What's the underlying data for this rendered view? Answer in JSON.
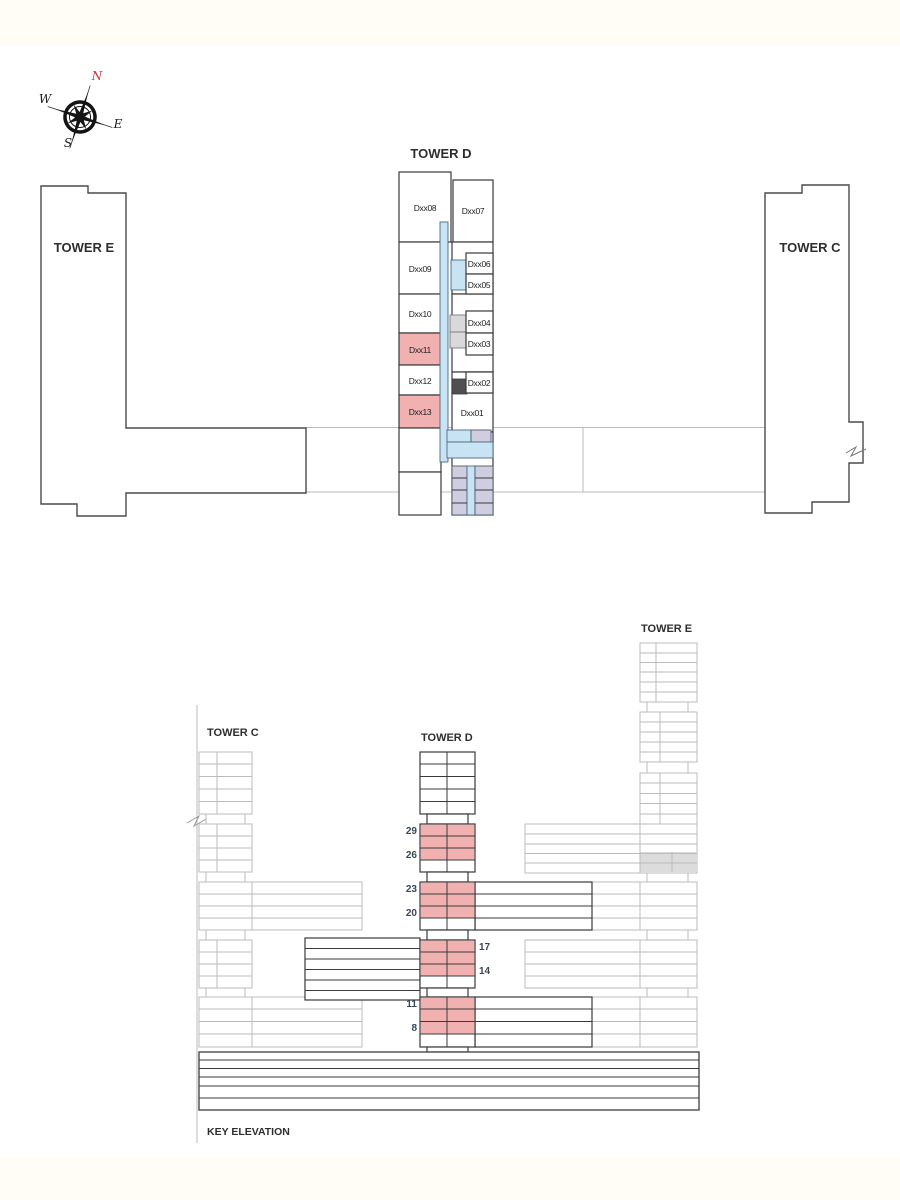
{
  "colors": {
    "highlight_pink": "#f1b1b1",
    "corridor_blue": "#c8e3f3",
    "core_lavender": "#d0cde0",
    "muted_gray": "#dcdcdc",
    "dark_gray_block": "#4f4f4f",
    "outline_dark": "#3a3a3a",
    "outline_faint": "#bbbbbb",
    "north_red": "#cc3333",
    "floor_label_navy": "#3b4557"
  },
  "compass": {
    "north": "N",
    "south": "S",
    "east": "E",
    "west": "W"
  },
  "plan": {
    "tower_d_title": "TOWER D",
    "tower_e_label": "TOWER E",
    "tower_c_label": "TOWER C",
    "units": {
      "u08": "Dxx08",
      "u09": "Dxx09",
      "u10": "Dxx10",
      "u11": "Dxx11",
      "u12": "Dxx12",
      "u13": "Dxx13",
      "u07": "Dxx07",
      "u06": "Dxx06",
      "u05": "Dxx05",
      "u04": "Dxx04",
      "u03": "Dxx03",
      "u02": "Dxx02",
      "u01": "Dxx01"
    },
    "highlighted_units": [
      "Dxx11",
      "Dxx13"
    ]
  },
  "elevation": {
    "title": "KEY ELEVATION",
    "tower_c_label": "TOWER C",
    "tower_d_label": "TOWER D",
    "tower_e_label": "TOWER E",
    "floors": {
      "f29": "29",
      "f26": "26",
      "f23": "23",
      "f20": "20",
      "f17": "17",
      "f14": "14",
      "f11": "11",
      "f8": "8"
    },
    "highlighted_floor_ranges": [
      "8-11",
      "14-17",
      "20-23",
      "26-29"
    ]
  }
}
